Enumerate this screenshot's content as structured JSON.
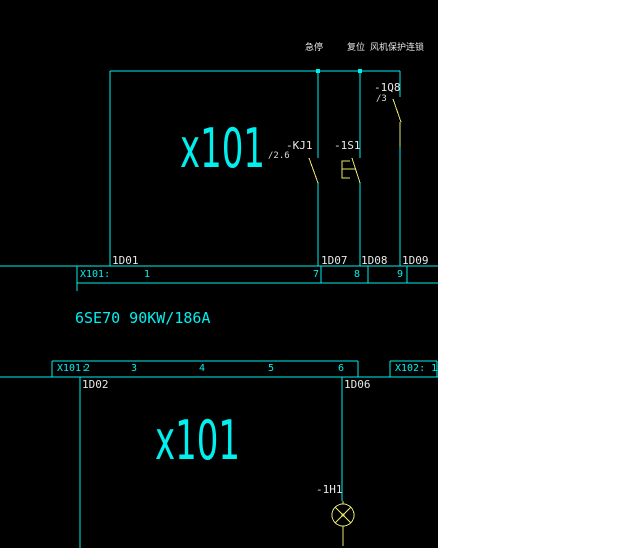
{
  "colors": {
    "canvas": "#000000",
    "side_panel": "#ffffff",
    "wire_cyan": "#00f0f0",
    "symbol_yellow": "#e6e66a",
    "text_white": "#e8e8e8"
  },
  "section1": {
    "signal_labels": {
      "estop": "急停",
      "reset": "复位",
      "fan_protect": "风机保护连锁"
    },
    "box_label": "x101",
    "components": {
      "kj1_tag": "-KJ1",
      "kj1_ref": "/2.6",
      "s1_tag": "-1S1",
      "q8_tag": "-1Q8",
      "q8_ref": "/3"
    },
    "wire_labels": {
      "w1": "1D01",
      "w7": "1D07",
      "w8": "1D08",
      "w9": "1D09"
    },
    "strip": {
      "label": "X101:",
      "n1": "1",
      "n7": "7",
      "n8": "8",
      "n9": "9"
    }
  },
  "drive_label": "6SE70 90KW/186A",
  "section2": {
    "strip": {
      "label": "X101:",
      "n2": "2",
      "n3": "3",
      "n4": "4",
      "n5": "5",
      "n6": "6"
    },
    "strip_x102": "X102: 13",
    "wire_labels": {
      "w2": "1D02",
      "w6": "1D06"
    },
    "box_label": "x101",
    "lamp_tag": "-1H1"
  }
}
